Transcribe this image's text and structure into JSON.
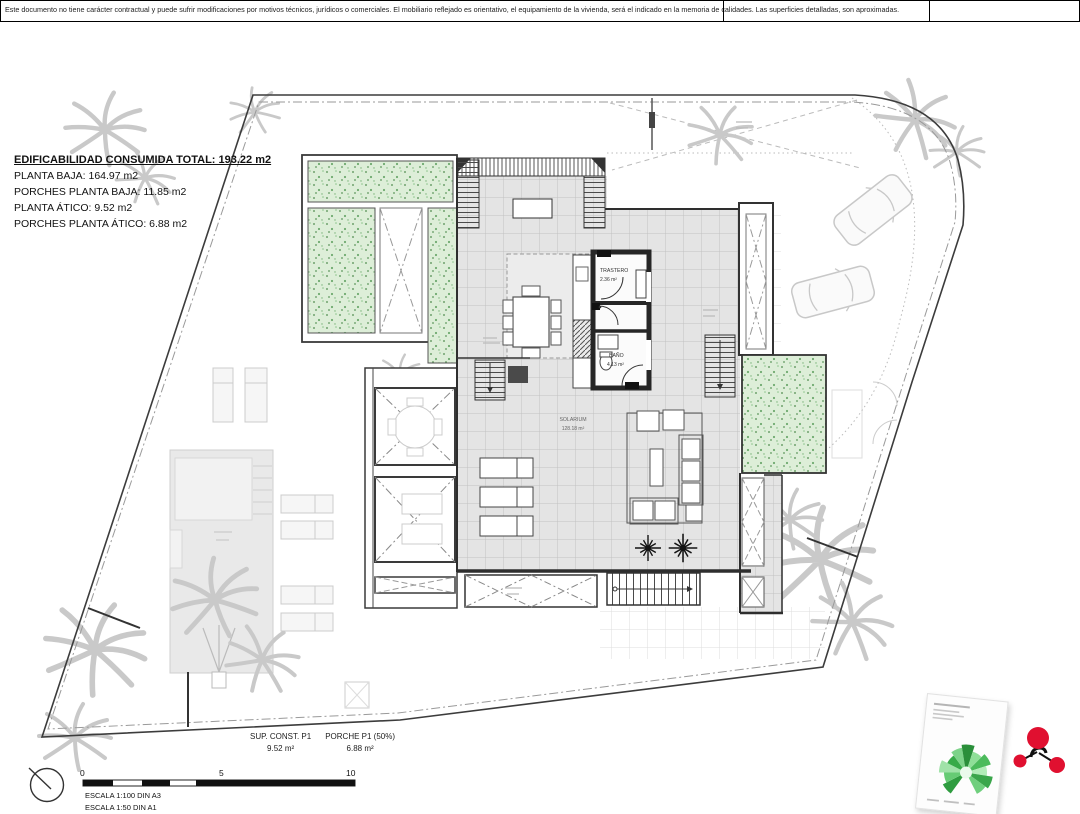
{
  "disclaimer": "Este documento no tiene carácter contractual y puede sufrir modificaciones por motivos técnicos, jurídicos o comerciales. El mobiliario reflejado es orientativo, el equipamiento de la vivienda, será el indicado en la memoria de calidades. Las superficies detalladas, son aproximadas.",
  "summary": {
    "title": "EDIFICABILIDAD CONSUMIDA TOTAL: 193.22 m2",
    "lines": [
      "PLANTA BAJA: 164.97 m2",
      "PORCHES PLANTA BAJA: 11.85 m2",
      "PLANTA ÁTICO: 9.52 m2",
      "PORCHES PLANTA ÁTICO: 6.88 m2"
    ]
  },
  "rooms": {
    "trastero": {
      "name": "TRASTERO",
      "area": "2.36 m²"
    },
    "bano": {
      "name": "BAÑO",
      "area": "4.13 m²"
    },
    "solarium": {
      "name": "SOLARIUM",
      "area": "128.18 m²"
    }
  },
  "totals": {
    "sup_const_label": "SUP. CONST. P1",
    "sup_const_value": "9.52 m²",
    "porche_label": "PORCHE P1 (50%)",
    "porche_value": "6.88 m²"
  },
  "scale": {
    "tick0": "0",
    "tick5": "5",
    "tick10": "10",
    "line1": "ESCALA 1:100 DIN A3",
    "line2": "ESCALA 1:50 DIN A1"
  },
  "colors": {
    "planter_green": "#ddeed8",
    "wall_dark": "#2b2b2b",
    "logo_red": "#e01030",
    "logo_green": "#3aa64b"
  }
}
